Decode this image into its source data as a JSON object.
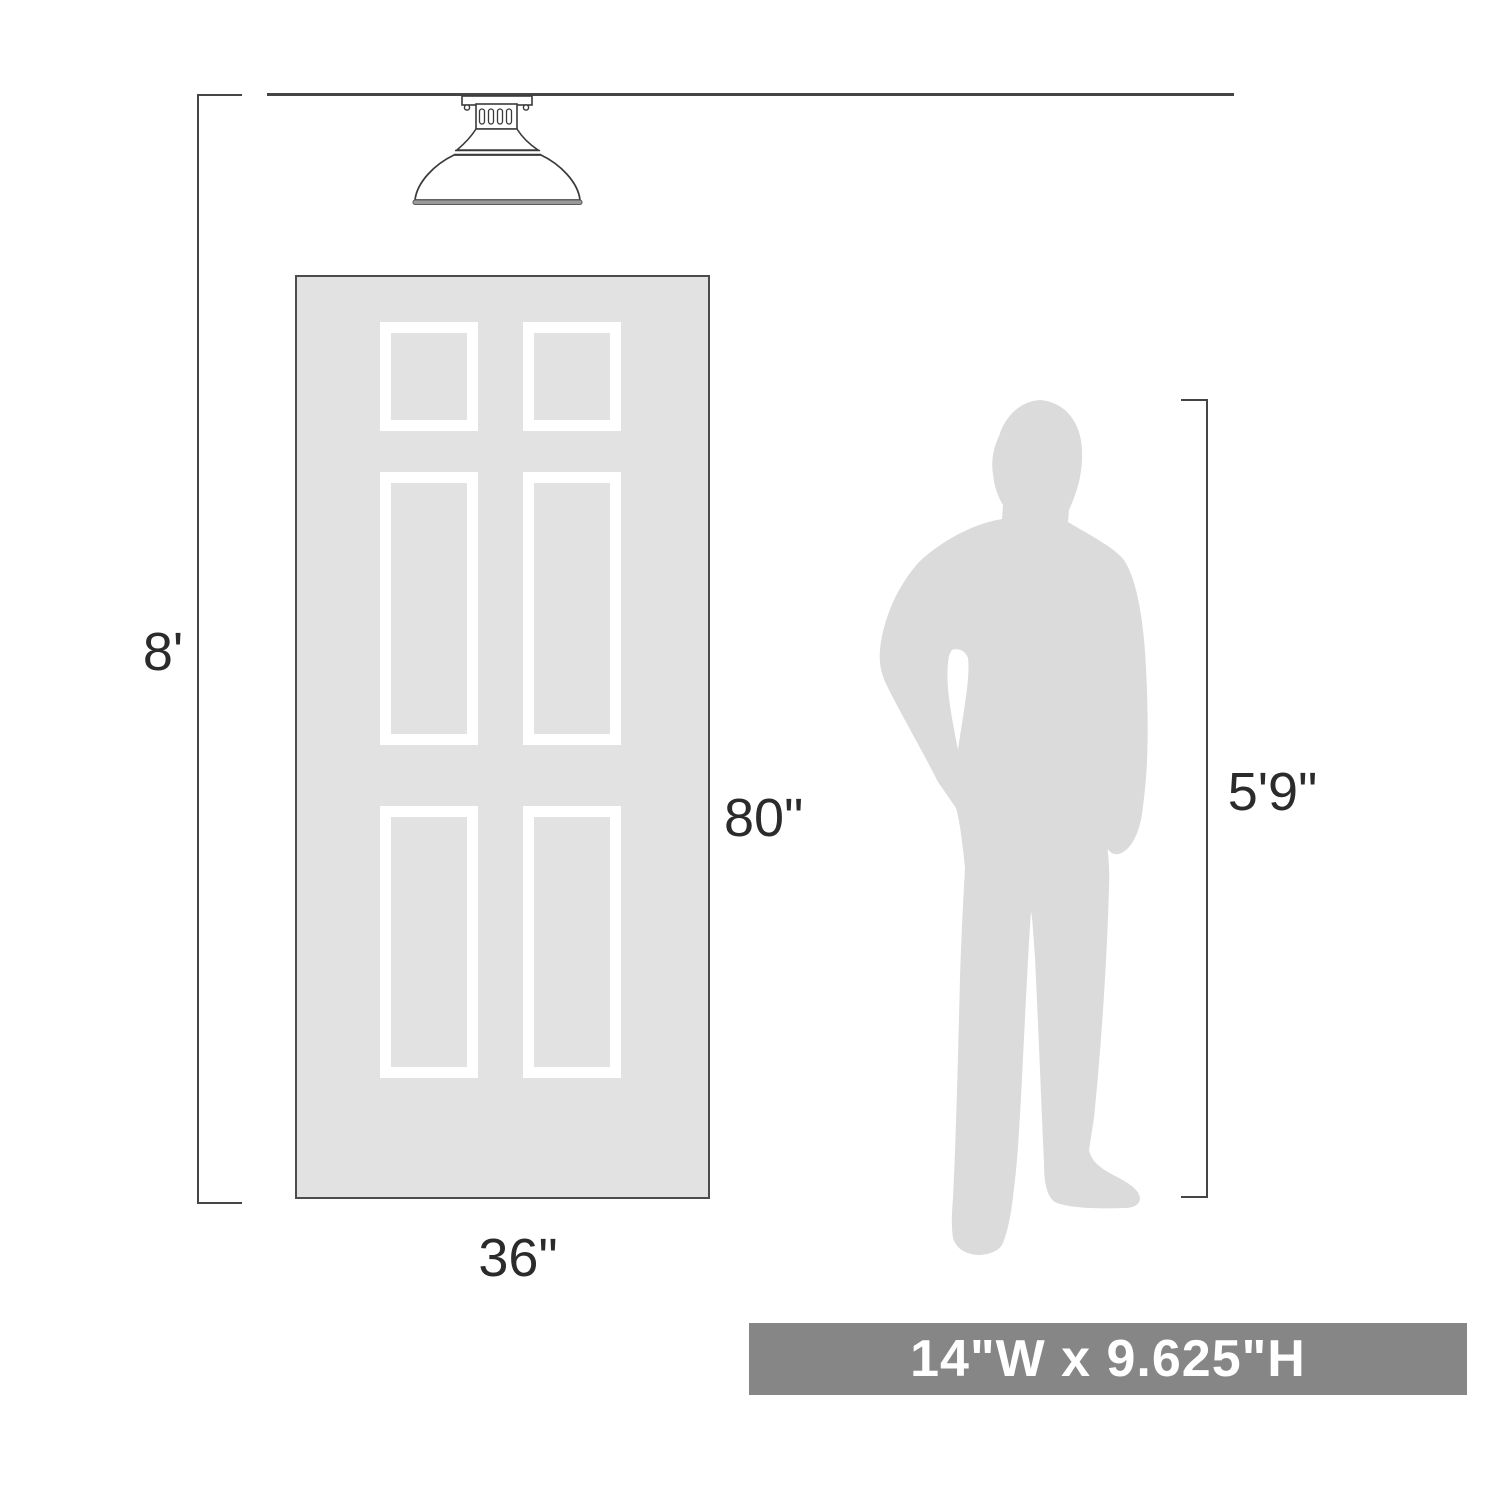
{
  "labels": {
    "ceiling_height": "8'",
    "door_height": "80\"",
    "door_width": "36\"",
    "person_height": "5'9\"",
    "fixture_size": "14\"W x 9.625\"H"
  },
  "icons": {
    "light_fixture": "semi-flush-dome-ceiling-light",
    "door": "six-panel-door",
    "person": "standing-man-silhouette"
  },
  "colors": {
    "dimension_line": "#454545",
    "label_text": "#2b2b2b",
    "door_fill": "#e2e2e2",
    "door_border": "#4c4c4c",
    "panel_frame": "#ffffff",
    "silhouette_fill": "#dbdbdb",
    "banner_background": "#868686",
    "banner_text": "#ffffff"
  }
}
